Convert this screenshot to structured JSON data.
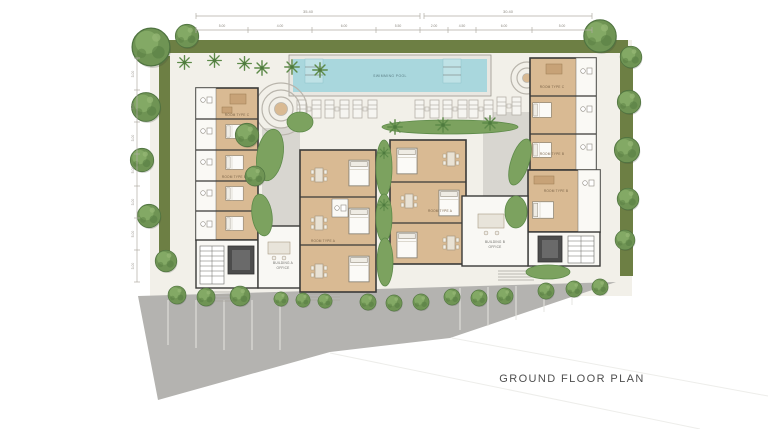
{
  "title": "GROUND FLOOR PLAN",
  "pool": {
    "label": "SWIMMING POOL"
  },
  "rooms": {
    "type_a": "ROOM TYPE A",
    "type_b": "ROOM TYPE B",
    "type_c": "ROOM TYPE C"
  },
  "offices": {
    "a_line1": "BUILDING A",
    "a_line2": "OFFICE",
    "b_line1": "BUILDING B",
    "b_line2": "OFFICE"
  },
  "dimensions": {
    "top_overall_left": "35.40",
    "top_overall_right": "30.40",
    "top_segments": [
      "5.00",
      "4.00",
      "6.00",
      "5.50",
      "2.00",
      "4.50",
      "6.00",
      "5.00"
    ],
    "left_segments": [
      "3.00",
      "5.00",
      "3.00",
      "5.00",
      "3.00",
      "5.00",
      "3.00"
    ]
  },
  "colors": {
    "site_ground": "#f2f0e9",
    "grass_border": "#6d7f44",
    "tree_green": "#6f9454",
    "hedge_green": "#7ca25f",
    "pool_water": "#a9d7dd",
    "room_floor_tan": "#d9ba93",
    "walls": "#3a3a38",
    "road_gray": "#b4b3b0",
    "elevator_dark": "#4c4c4c",
    "title_text": "#4f4f4f"
  }
}
